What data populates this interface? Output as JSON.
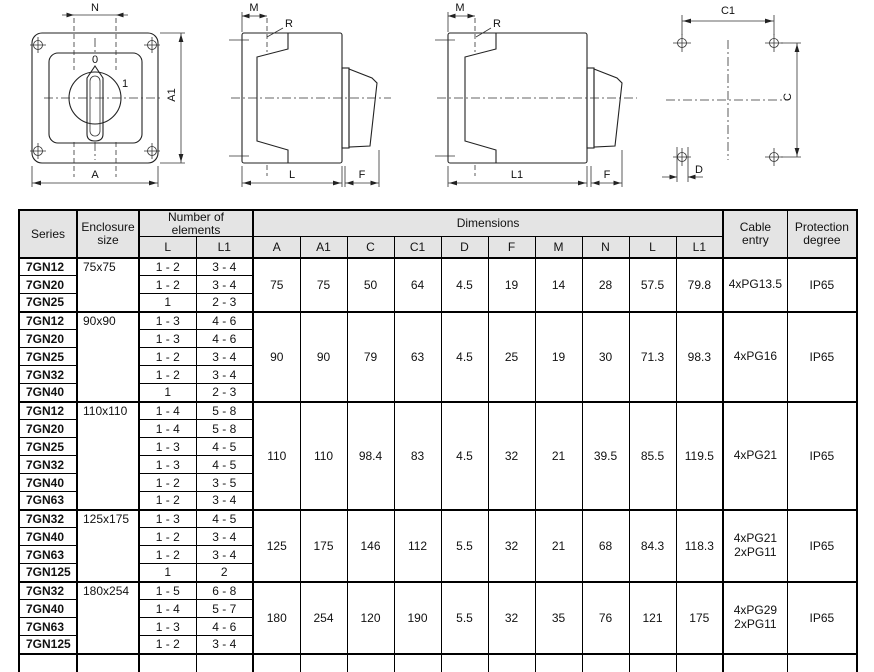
{
  "colors": {
    "line": "#222222",
    "body_fill": "#e9e9e9",
    "inner_fill": "#e2e2e2",
    "knob_fill": "#d6d6d6",
    "handle_fill": "#c9c9c9",
    "handle_inner": "#f5f5f5",
    "header_bg": "#e4e4e4",
    "text": "#111111"
  },
  "drawings": {
    "front_view": {
      "dim_top": "N",
      "dim_side": "A1",
      "dim_bottom": "A",
      "position_marks": {
        "zero": "0",
        "one": "1"
      }
    },
    "side_view_short": {
      "dim_top": "M",
      "radius_label": "R",
      "dim_length": "L",
      "dim_front": "F"
    },
    "side_view_long": {
      "dim_top": "M",
      "radius_label": "R",
      "dim_length": "L1",
      "dim_front": "F"
    },
    "drilling_template": {
      "dim_top": "C1",
      "dim_side": "C",
      "dim_hole": "D"
    }
  },
  "table": {
    "headers": {
      "series": "Series",
      "enclosure": "Enclosure size",
      "elements": "Number of elements",
      "elements_sub": [
        "L",
        "L1"
      ],
      "dimensions": "Dimensions",
      "dimension_cols": [
        "A",
        "A1",
        "C",
        "C1",
        "D",
        "F",
        "M",
        "N",
        "L",
        "L1"
      ],
      "cable": "Cable entry",
      "protection": "Protection degree"
    },
    "groups": [
      {
        "enclosure": "75x75",
        "rows": [
          {
            "series": "7GN12",
            "L": "1 - 2",
            "L1": "3 - 4"
          },
          {
            "series": "7GN20",
            "L": "1 - 2",
            "L1": "3 - 4"
          },
          {
            "series": "7GN25",
            "L": "1",
            "L1": "2 - 3"
          }
        ],
        "dims": [
          "75",
          "75",
          "50",
          "64",
          "4.5",
          "19",
          "14",
          "28",
          "57.5",
          "79.8"
        ],
        "cable": [
          "4xPG13.5"
        ],
        "protection": "IP65"
      },
      {
        "enclosure": "90x90",
        "rows": [
          {
            "series": "7GN12",
            "L": "1 - 3",
            "L1": "4 - 6"
          },
          {
            "series": "7GN20",
            "L": "1 - 3",
            "L1": "4 - 6"
          },
          {
            "series": "7GN25",
            "L": "1 - 2",
            "L1": "3 - 4"
          },
          {
            "series": "7GN32",
            "L": "1 - 2",
            "L1": "3 - 4"
          },
          {
            "series": "7GN40",
            "L": "1",
            "L1": "2 - 3"
          }
        ],
        "dims": [
          "90",
          "90",
          "79",
          "63",
          "4.5",
          "25",
          "19",
          "30",
          "71.3",
          "98.3"
        ],
        "cable": [
          "4xPG16"
        ],
        "protection": "IP65"
      },
      {
        "enclosure": "110x110",
        "rows": [
          {
            "series": "7GN12",
            "L": "1 - 4",
            "L1": "5 - 8"
          },
          {
            "series": "7GN20",
            "L": "1 - 4",
            "L1": "5 - 8"
          },
          {
            "series": "7GN25",
            "L": "1 - 3",
            "L1": "4 - 5"
          },
          {
            "series": "7GN32",
            "L": "1 - 3",
            "L1": "4 - 5"
          },
          {
            "series": "7GN40",
            "L": "1 - 2",
            "L1": "3 - 5"
          },
          {
            "series": "7GN63",
            "L": "1 - 2",
            "L1": "3 - 4"
          }
        ],
        "dims": [
          "110",
          "110",
          "98.4",
          "83",
          "4.5",
          "32",
          "21",
          "39.5",
          "85.5",
          "119.5"
        ],
        "cable": [
          "4xPG21"
        ],
        "protection": "IP65"
      },
      {
        "enclosure": "125x175",
        "rows": [
          {
            "series": "7GN32",
            "L": "1 - 3",
            "L1": "4 - 5"
          },
          {
            "series": "7GN40",
            "L": "1 - 2",
            "L1": "3 - 4"
          },
          {
            "series": "7GN63",
            "L": "1 - 2",
            "L1": "3 - 4"
          },
          {
            "series": "7GN125",
            "L": "1",
            "L1": "2"
          }
        ],
        "dims": [
          "125",
          "175",
          "146",
          "112",
          "5.5",
          "32",
          "21",
          "68",
          "84.3",
          "118.3"
        ],
        "cable": [
          "4xPG21",
          "2xPG11"
        ],
        "protection": "IP65"
      },
      {
        "enclosure": "180x254",
        "rows": [
          {
            "series": "7GN32",
            "L": "1 - 5",
            "L1": "6 - 8"
          },
          {
            "series": "7GN40",
            "L": "1 - 4",
            "L1": "5 - 7"
          },
          {
            "series": "7GN63",
            "L": "1 - 3",
            "L1": "4 - 6"
          },
          {
            "series": "7GN125",
            "L": "1 - 2",
            "L1": "3 - 4"
          }
        ],
        "dims": [
          "180",
          "254",
          "120",
          "190",
          "5.5",
          "32",
          "35",
          "76",
          "121",
          "175"
        ],
        "cable": [
          "4xPG29",
          "2xPG11"
        ],
        "protection": "IP65"
      }
    ]
  }
}
